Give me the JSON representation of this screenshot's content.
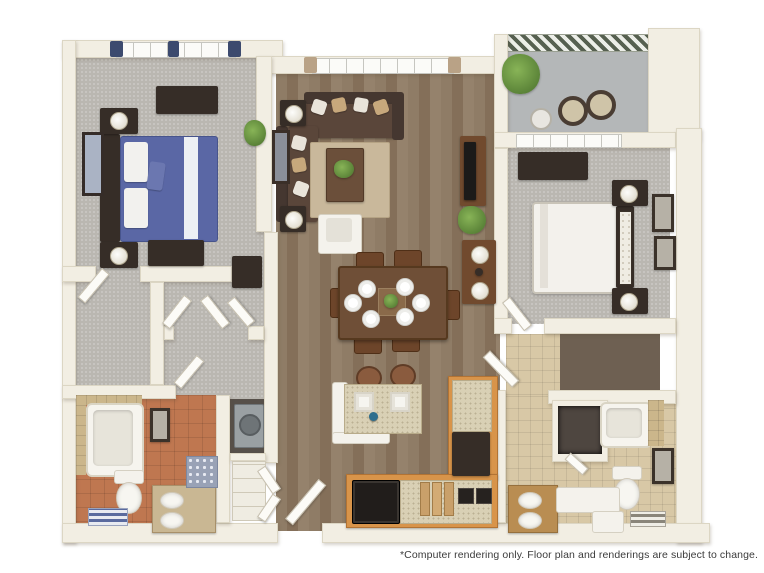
{
  "disclaimer": "*Computer rendering only. Floor plan and renderings are subject to change.",
  "palette": {
    "wall_cream": "#f2eee3",
    "hardwood": "#8f7c66",
    "carpet_gray": "#bab7b1",
    "closet_carpet_dark": "#6e6052",
    "balcony_concrete": "#b4b7b8",
    "terracotta_tile": "#bf7750",
    "tan_tile": "#d8c8a6",
    "kitchen_cabinet_orange": "#d8944a",
    "counter_speckled_beige": "#d9d0b5",
    "dark_furniture": "#362d27",
    "wood_furniture": "#714a2e",
    "sofa_brown": "#5a463a",
    "bed1_blue": "#5a67a5",
    "bed2_white": "#f3f1ec",
    "plant_green": "#5d8c3c",
    "faucet_teal": "#2e6e8e",
    "curtain_navy": "#3c4a6e",
    "disclaimer_text": "#3b3b3b"
  },
  "floor_plan": {
    "description": "3D top-down computer rendering of a two-bedroom, two-bathroom apartment",
    "rooms": [
      {
        "name": "bedroom-1",
        "floor": "gray carpet",
        "furniture": [
          "window with navy curtains",
          "dark dresser",
          "bed with blue and white bedding",
          "dark headboard",
          "two nightstands with lamps",
          "wall mirror",
          "potted plant",
          "storage chest"
        ]
      },
      {
        "name": "living-room",
        "floor": "hardwood",
        "furniture": [
          "window with curtains",
          "L-shaped brown sectional with pillows",
          "two side tables with lamps",
          "coffee table with greenery",
          "tan area rug",
          "white armchair",
          "media console with TV",
          "floor plant",
          "leaning art frame"
        ]
      },
      {
        "name": "dining-area",
        "floor": "hardwood",
        "furniture": [
          "rectangular wood table",
          "six chairs",
          "six white place settings",
          "centerpiece"
        ]
      },
      {
        "name": "kitchen",
        "floor": "hardwood",
        "furniture": [
          "island with double sink and faucet",
          "two barstools",
          "L-shaped orange cabinets",
          "refrigerator",
          "black range",
          "cooktop burners",
          "cutting boards"
        ]
      },
      {
        "name": "balcony",
        "floor": "concrete",
        "furniture": [
          "metal railing",
          "potted plant",
          "two round chairs",
          "side table"
        ]
      },
      {
        "name": "bedroom-2",
        "floor": "gray carpet",
        "furniture": [
          "window",
          "dark dresser",
          "white bed with tufted headboard",
          "two nightstands with lamps",
          "two framed pictures"
        ]
      },
      {
        "name": "bathroom-1",
        "floor": "terracotta tile",
        "furniture": [
          "tub shower with tan tile surround",
          "toilet",
          "double vanity with two sinks",
          "decorative rug",
          "framed art",
          "striped bath mat"
        ]
      },
      {
        "name": "bathroom-2",
        "floor": "tan tile",
        "furniture": [
          "bathtub with tile surround",
          "linen closet",
          "toilet",
          "vanity with two sinks",
          "white counter cabinet",
          "framed art",
          "striped bath mat"
        ]
      },
      {
        "name": "laundry-closet",
        "floor": "dark",
        "furniture": [
          "washer dryer unit"
        ]
      },
      {
        "name": "walk-in-closet-1",
        "floor": "gray carpet",
        "furniture": [
          "double doors",
          "storage niche"
        ]
      },
      {
        "name": "walk-in-closet-2",
        "floor": "dark carpet",
        "furniture": []
      },
      {
        "name": "entry",
        "floor": "hardwood",
        "furniture": [
          "entry door"
        ]
      }
    ]
  }
}
